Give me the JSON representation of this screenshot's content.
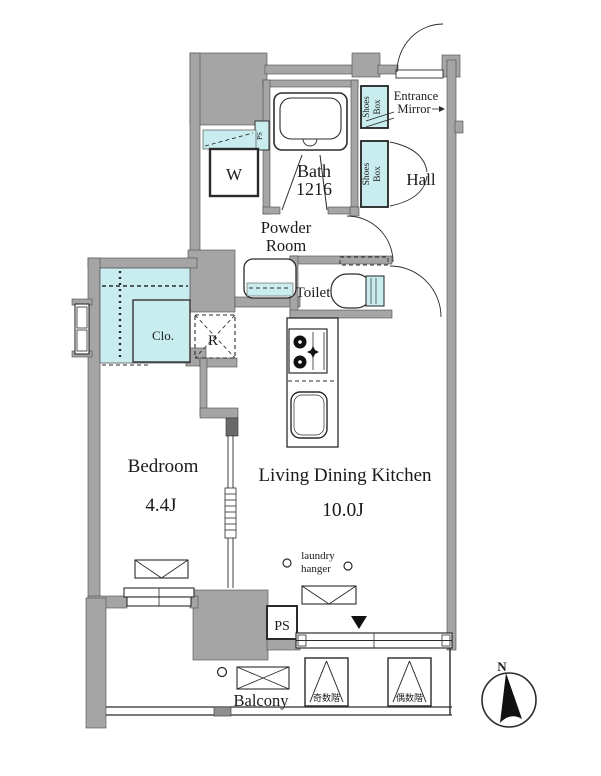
{
  "colors": {
    "wall": "#a5a5a5",
    "accent": "#c9edef",
    "text": "#1a1a1a"
  },
  "rooms": {
    "bath": {
      "label": "Bath",
      "size": "1216"
    },
    "powder": {
      "line1": "Powder",
      "line2": "Room"
    },
    "toilet": {
      "label": "Toilet"
    },
    "hall": {
      "label": "Hall"
    },
    "entrance_mirror": {
      "line1": "Entrance",
      "line2": "Mirror"
    },
    "shoes_box": {
      "word1": "Shoes",
      "word2": "Box"
    },
    "washer": {
      "label": "W"
    },
    "closet": {
      "label": "Clo."
    },
    "fridge": {
      "label": "R"
    },
    "bedroom": {
      "label": "Bedroom",
      "size": "4.4J"
    },
    "ldk": {
      "label": "Living Dining Kitchen",
      "size": "10.0J"
    },
    "laundry_hanger": {
      "line1": "laundry",
      "line2": "hanger"
    },
    "ps": {
      "label": "PS"
    },
    "ps_small": {
      "label": "PS"
    },
    "balcony": {
      "label": "Balcony"
    },
    "hatch_odd": {
      "label": "奇数階"
    },
    "hatch_even": {
      "label": "偶数階"
    },
    "compass": {
      "north": "N"
    }
  }
}
